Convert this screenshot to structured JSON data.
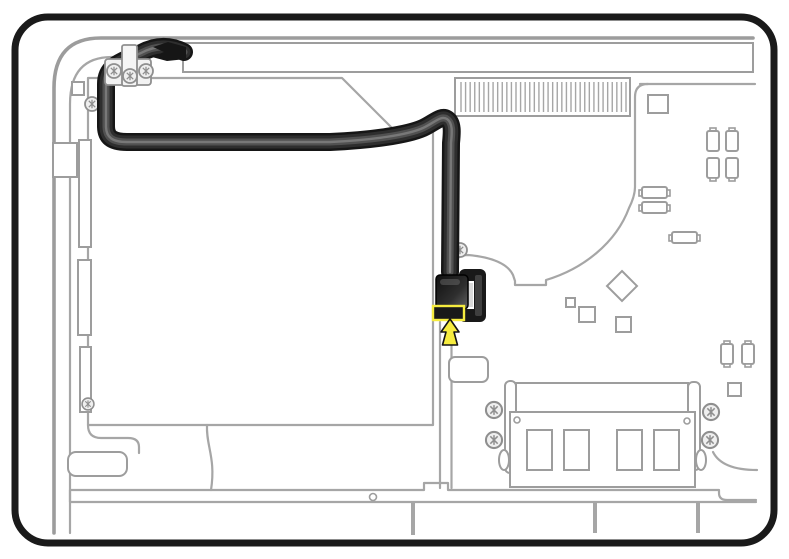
{
  "diagram": {
    "kind": "hardware-service-illustration",
    "subject": "display-cable-routing",
    "highlighted_part": "display-cable-connector",
    "callouts": {
      "highlight_box": "connector-location-outline",
      "arrow": "arrow-pointing-up-at-connector"
    },
    "parts": [
      "rear-housing-frame",
      "chassis-walls",
      "display-panel-edge",
      "drive-bay",
      "cable-clamp",
      "display-cable",
      "cable-connector",
      "fan-housing-outline",
      "heatsink-vent",
      "logic-board-components",
      "memory-module",
      "bottom-rail"
    ]
  },
  "colors": {
    "page_bg": "#ffffff",
    "frame_black": "#1a1a1a",
    "outline_gray": "#a6a6a6",
    "cable_edge": "#161616",
    "cable_dark": "#2e2e2e",
    "cable_sheen": "#6f6f6f",
    "cable_gloss": "#a0a0a0",
    "connector_dark": "#191919",
    "highlight_yellow": "#f6ec3f",
    "screw_fill": "#efefef"
  },
  "counts": {
    "vent_fins": 37,
    "memory_chips": 4,
    "memory_retainer_screws": 4,
    "clamp_screws": 3,
    "bottom_rail_ticks": 3
  }
}
